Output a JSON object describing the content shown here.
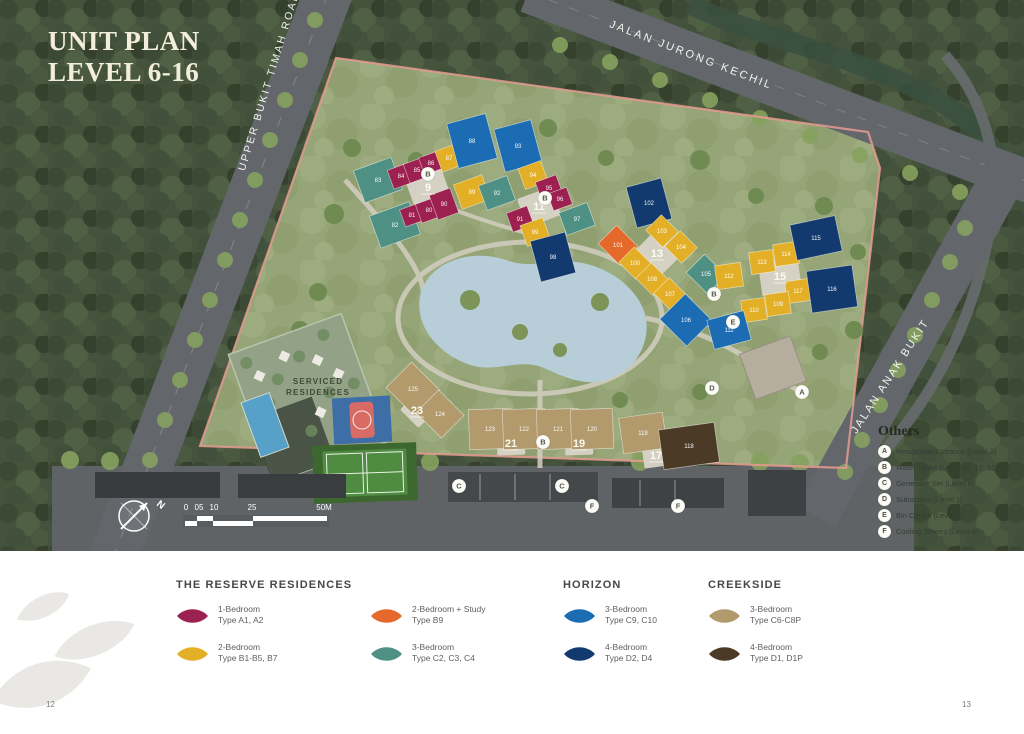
{
  "page": {
    "title_line1": "UNIT PLAN",
    "title_line2": "LEVEL 6-16",
    "page_left": "12",
    "page_right": "13"
  },
  "colors": {
    "maroon": "#9c2050",
    "yellow": "#e3af26",
    "orange": "#e4692a",
    "teal": "#4e9184",
    "blue": "#1b6cb3",
    "navy": "#123a6e",
    "tan": "#b29a6d",
    "brown": "#4a3a26"
  },
  "map": {
    "roads": [
      {
        "name": "UPPER BUKIT TIMAH ROAD"
      },
      {
        "name": "JALAN JURONG KECHIL"
      },
      {
        "name": "JALAN ANAK BUKIT"
      }
    ],
    "serviced": {
      "line1": "SERVICED",
      "line2": "RESIDENCES"
    },
    "compass_n": "N",
    "scale": {
      "ticks": [
        "0",
        "05",
        "10",
        "25",
        "50M"
      ]
    },
    "towers": [
      {
        "label": "9",
        "x": 428,
        "y": 188,
        "r": -20,
        "pw": 38,
        "ph": 32
      },
      {
        "label": "11",
        "x": 539,
        "y": 207,
        "r": -20,
        "pw": 36,
        "ph": 30
      },
      {
        "label": "13",
        "x": 657,
        "y": 254,
        "r": 45,
        "pw": 36,
        "ph": 32
      },
      {
        "label": "15",
        "x": 780,
        "y": 277,
        "r": -8,
        "pw": 40,
        "ph": 34
      },
      {
        "label": "17",
        "x": 656,
        "y": 456,
        "r": -8,
        "pw": 26,
        "ph": 22
      },
      {
        "label": "19",
        "x": 579,
        "y": 444,
        "r": -2,
        "pw": 28,
        "ph": 22
      },
      {
        "label": "21",
        "x": 511,
        "y": 444,
        "r": -2,
        "pw": 28,
        "ph": 22
      },
      {
        "label": "23",
        "x": 417,
        "y": 411,
        "r": 45,
        "pw": 26,
        "ph": 22
      }
    ],
    "buildings": [
      {
        "label": "83",
        "x": 378,
        "y": 180,
        "w": 40,
        "h": 34,
        "r": -20,
        "c": "teal"
      },
      {
        "label": "84",
        "x": 401,
        "y": 176,
        "w": 22,
        "h": 20,
        "r": -20,
        "c": "maroon"
      },
      {
        "label": "85",
        "x": 417,
        "y": 170,
        "w": 22,
        "h": 20,
        "r": -20,
        "c": "maroon"
      },
      {
        "label": "86",
        "x": 431,
        "y": 163,
        "w": 20,
        "h": 18,
        "r": -20,
        "c": "maroon"
      },
      {
        "label": "87",
        "x": 449,
        "y": 158,
        "w": 22,
        "h": 22,
        "r": -20,
        "c": "yellow"
      },
      {
        "label": "88",
        "x": 472,
        "y": 141,
        "w": 40,
        "h": 46,
        "r": -15,
        "c": "blue"
      },
      {
        "label": "82",
        "x": 395,
        "y": 225,
        "w": 42,
        "h": 34,
        "r": -20,
        "c": "teal"
      },
      {
        "label": "81",
        "x": 412,
        "y": 215,
        "w": 20,
        "h": 18,
        "r": -20,
        "c": "maroon"
      },
      {
        "label": "80",
        "x": 429,
        "y": 210,
        "w": 22,
        "h": 20,
        "r": -20,
        "c": "maroon"
      },
      {
        "label": "90",
        "x": 444,
        "y": 204,
        "w": 22,
        "h": 26,
        "r": -20,
        "c": "maroon"
      },
      {
        "label": "89",
        "x": 472,
        "y": 192,
        "w": 30,
        "h": 26,
        "r": -20,
        "c": "yellow"
      },
      {
        "label": "93",
        "x": 518,
        "y": 146,
        "w": 38,
        "h": 44,
        "r": -15,
        "c": "blue"
      },
      {
        "label": "92",
        "x": 497,
        "y": 193,
        "w": 30,
        "h": 26,
        "r": -20,
        "c": "teal"
      },
      {
        "label": "94",
        "x": 533,
        "y": 175,
        "w": 24,
        "h": 22,
        "r": -20,
        "c": "yellow"
      },
      {
        "label": "95",
        "x": 549,
        "y": 188,
        "w": 22,
        "h": 20,
        "r": -20,
        "c": "maroon"
      },
      {
        "label": "96",
        "x": 560,
        "y": 199,
        "w": 20,
        "h": 18,
        "r": -20,
        "c": "maroon"
      },
      {
        "label": "91",
        "x": 520,
        "y": 219,
        "w": 22,
        "h": 20,
        "r": -20,
        "c": "maroon"
      },
      {
        "label": "99",
        "x": 535,
        "y": 232,
        "w": 24,
        "h": 22,
        "r": -20,
        "c": "yellow"
      },
      {
        "label": "97",
        "x": 577,
        "y": 219,
        "w": 30,
        "h": 24,
        "r": -20,
        "c": "teal"
      },
      {
        "label": "98",
        "x": 553,
        "y": 257,
        "w": 36,
        "h": 42,
        "r": -15,
        "c": "navy"
      },
      {
        "label": "102",
        "x": 649,
        "y": 203,
        "w": 36,
        "h": 42,
        "r": -15,
        "c": "navy"
      },
      {
        "label": "101",
        "x": 618,
        "y": 245,
        "w": 30,
        "h": 26,
        "r": 45,
        "c": "orange"
      },
      {
        "label": "103",
        "x": 662,
        "y": 231,
        "w": 24,
        "h": 22,
        "r": 45,
        "c": "yellow"
      },
      {
        "label": "104",
        "x": 681,
        "y": 247,
        "w": 24,
        "h": 22,
        "r": 45,
        "c": "yellow"
      },
      {
        "label": "100",
        "x": 635,
        "y": 263,
        "w": 24,
        "h": 22,
        "r": 45,
        "c": "yellow"
      },
      {
        "label": "108",
        "x": 652,
        "y": 279,
        "w": 24,
        "h": 22,
        "r": 45,
        "c": "yellow"
      },
      {
        "label": "107",
        "x": 670,
        "y": 294,
        "w": 24,
        "h": 22,
        "r": 45,
        "c": "yellow"
      },
      {
        "label": "105",
        "x": 706,
        "y": 274,
        "w": 30,
        "h": 26,
        "r": 45,
        "c": "teal"
      },
      {
        "label": "106",
        "x": 686,
        "y": 320,
        "w": 38,
        "h": 36,
        "r": 45,
        "c": "blue"
      },
      {
        "label": "112",
        "x": 729,
        "y": 276,
        "w": 26,
        "h": 24,
        "r": -8,
        "c": "yellow"
      },
      {
        "label": "113",
        "x": 762,
        "y": 262,
        "w": 24,
        "h": 22,
        "r": -8,
        "c": "yellow"
      },
      {
        "label": "114",
        "x": 786,
        "y": 254,
        "w": 24,
        "h": 22,
        "r": -8,
        "c": "yellow"
      },
      {
        "label": "117",
        "x": 798,
        "y": 291,
        "w": 24,
        "h": 22,
        "r": -8,
        "c": "yellow"
      },
      {
        "label": "109",
        "x": 778,
        "y": 304,
        "w": 24,
        "h": 22,
        "r": -8,
        "c": "yellow"
      },
      {
        "label": "110",
        "x": 754,
        "y": 310,
        "w": 24,
        "h": 22,
        "r": -8,
        "c": "yellow"
      },
      {
        "label": "115",
        "x": 816,
        "y": 238,
        "w": 46,
        "h": 36,
        "r": -12,
        "c": "navy"
      },
      {
        "label": "116",
        "x": 832,
        "y": 289,
        "w": 46,
        "h": 42,
        "r": -8,
        "c": "navy"
      },
      {
        "label": "111",
        "x": 729,
        "y": 330,
        "w": 38,
        "h": 30,
        "r": -15,
        "c": "blue"
      },
      {
        "label": "125",
        "x": 413,
        "y": 389,
        "w": 40,
        "h": 36,
        "r": 45,
        "c": "tan"
      },
      {
        "label": "124",
        "x": 440,
        "y": 414,
        "w": 36,
        "h": 32,
        "r": 45,
        "c": "tan"
      },
      {
        "label": "123",
        "x": 490,
        "y": 429,
        "w": 42,
        "h": 40,
        "r": -2,
        "c": "tan"
      },
      {
        "label": "122",
        "x": 524,
        "y": 429,
        "w": 42,
        "h": 40,
        "r": -2,
        "c": "tan"
      },
      {
        "label": "121",
        "x": 558,
        "y": 429,
        "w": 42,
        "h": 40,
        "r": -2,
        "c": "tan"
      },
      {
        "label": "120",
        "x": 592,
        "y": 429,
        "w": 42,
        "h": 40,
        "r": -2,
        "c": "tan"
      },
      {
        "label": "119",
        "x": 643,
        "y": 433,
        "w": 44,
        "h": 36,
        "r": -8,
        "c": "tan"
      },
      {
        "label": "118",
        "x": 689,
        "y": 446,
        "w": 56,
        "h": 40,
        "r": -8,
        "c": "brown"
      }
    ],
    "markers": [
      {
        "letter": "A",
        "x": 802,
        "y": 392
      },
      {
        "letter": "B",
        "x": 428,
        "y": 174
      },
      {
        "letter": "B",
        "x": 545,
        "y": 198
      },
      {
        "letter": "B",
        "x": 714,
        "y": 294
      },
      {
        "letter": "B",
        "x": 543,
        "y": 442
      },
      {
        "letter": "C",
        "x": 459,
        "y": 486
      },
      {
        "letter": "C",
        "x": 562,
        "y": 486
      },
      {
        "letter": "D",
        "x": 712,
        "y": 388
      },
      {
        "letter": "E",
        "x": 733,
        "y": 322
      },
      {
        "letter": "F",
        "x": 592,
        "y": 506
      },
      {
        "letter": "F",
        "x": 678,
        "y": 506
      }
    ]
  },
  "others_legend": {
    "title": "Others",
    "items": [
      {
        "letter": "A",
        "label": "Residential Entrance (Level 3)"
      },
      {
        "letter": "B",
        "label": "Water Tanks (Level 12, 17, 31, 32)"
      },
      {
        "letter": "C",
        "label": "Generator Set (Level 6)"
      },
      {
        "letter": "D",
        "label": "Substation (Level 1)"
      },
      {
        "letter": "E",
        "label": "Bin Centre (Level 1)"
      },
      {
        "letter": "F",
        "label": "Cooling Towers (Level 4)"
      }
    ]
  },
  "legend": {
    "groups": [
      {
        "title": "THE RESERVE RESIDENCES",
        "items": [
          {
            "line1": "1-Bedroom",
            "line2": "Type A1, A2",
            "c": "maroon"
          },
          {
            "line1": "2-Bedroom",
            "line2": "Type B1-B5, B7",
            "c": "yellow"
          },
          {
            "line1": "2-Bedroom + Study",
            "line2": "Type B9",
            "c": "orange"
          },
          {
            "line1": "3-Bedroom",
            "line2": "Type C2, C3, C4",
            "c": "teal"
          }
        ]
      },
      {
        "title": "HORIZON",
        "items": [
          {
            "line1": "3-Bedroom",
            "line2": "Type C9, C10",
            "c": "blue"
          },
          {
            "line1": "4-Bedroom",
            "line2": "Type D2, D4",
            "c": "navy"
          }
        ]
      },
      {
        "title": "CREEKSIDE",
        "items": [
          {
            "line1": "3-Bedroom",
            "line2": "Type C6-C8P",
            "c": "tan"
          },
          {
            "line1": "4-Bedroom",
            "line2": "Type D1, D1P",
            "c": "brown"
          }
        ]
      }
    ]
  }
}
